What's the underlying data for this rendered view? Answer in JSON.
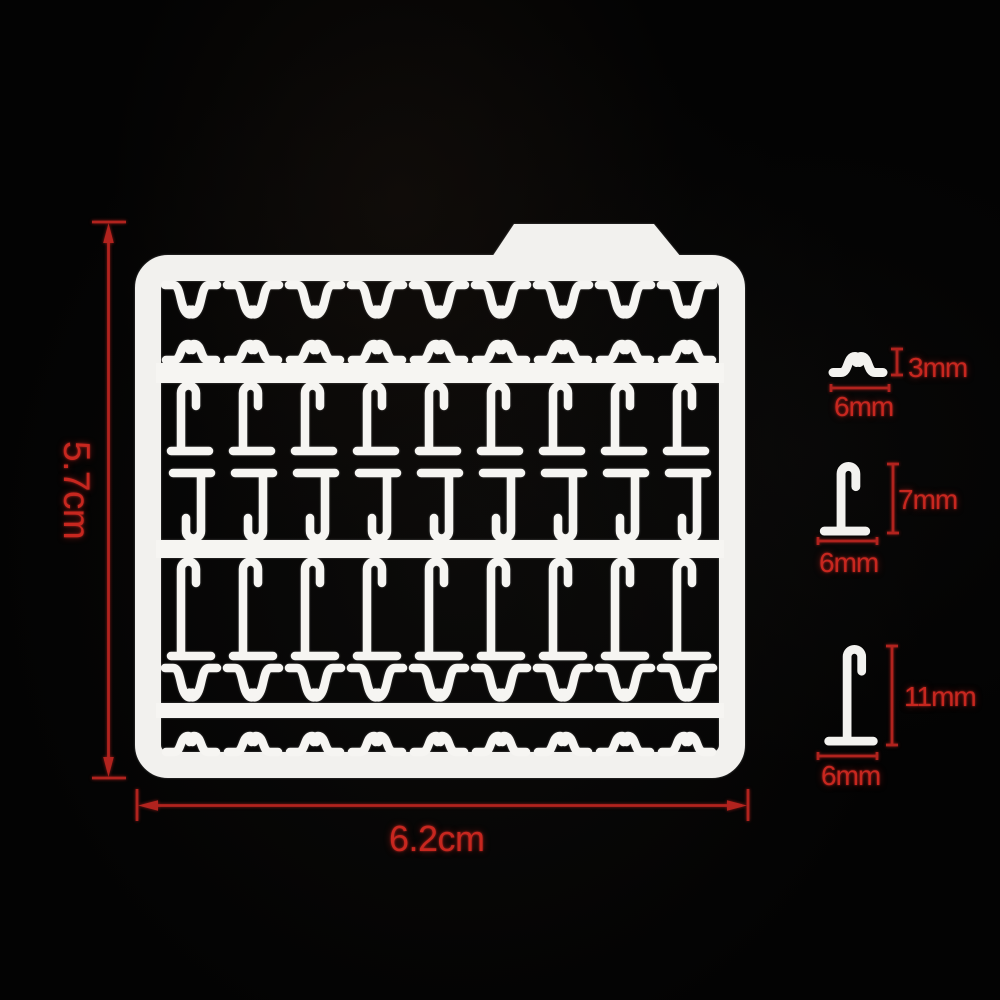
{
  "scene": {
    "description": "Product photo on black background: white plastic bait-stop sprue with red dimension annotations",
    "background_color": "#030303",
    "product_color": "#f2f1ee",
    "accent_color": "#c7271f"
  },
  "sprue": {
    "height_label": "5.7cm",
    "width_label": "6.2cm",
    "rows": [
      {
        "type": "small-stop-hanging",
        "count": 9
      },
      {
        "type": "small-stop-upright",
        "count": 9
      },
      {
        "type": "hook-stop-7mm",
        "count": 9
      },
      {
        "type": "hook-stop-7mm-inverted",
        "count": 9
      },
      {
        "type": "hook-stop-11mm",
        "count": 9
      },
      {
        "type": "small-stop-hanging",
        "count": 9
      },
      {
        "type": "small-stop-upright",
        "count": 9
      }
    ]
  },
  "pieces": [
    {
      "name": "small-stop",
      "height_label": "3mm",
      "width_label": "6mm"
    },
    {
      "name": "medium-stop",
      "height_label": "7mm",
      "width_label": "6mm"
    },
    {
      "name": "large-stop",
      "height_label": "11mm",
      "width_label": "6mm"
    }
  ]
}
